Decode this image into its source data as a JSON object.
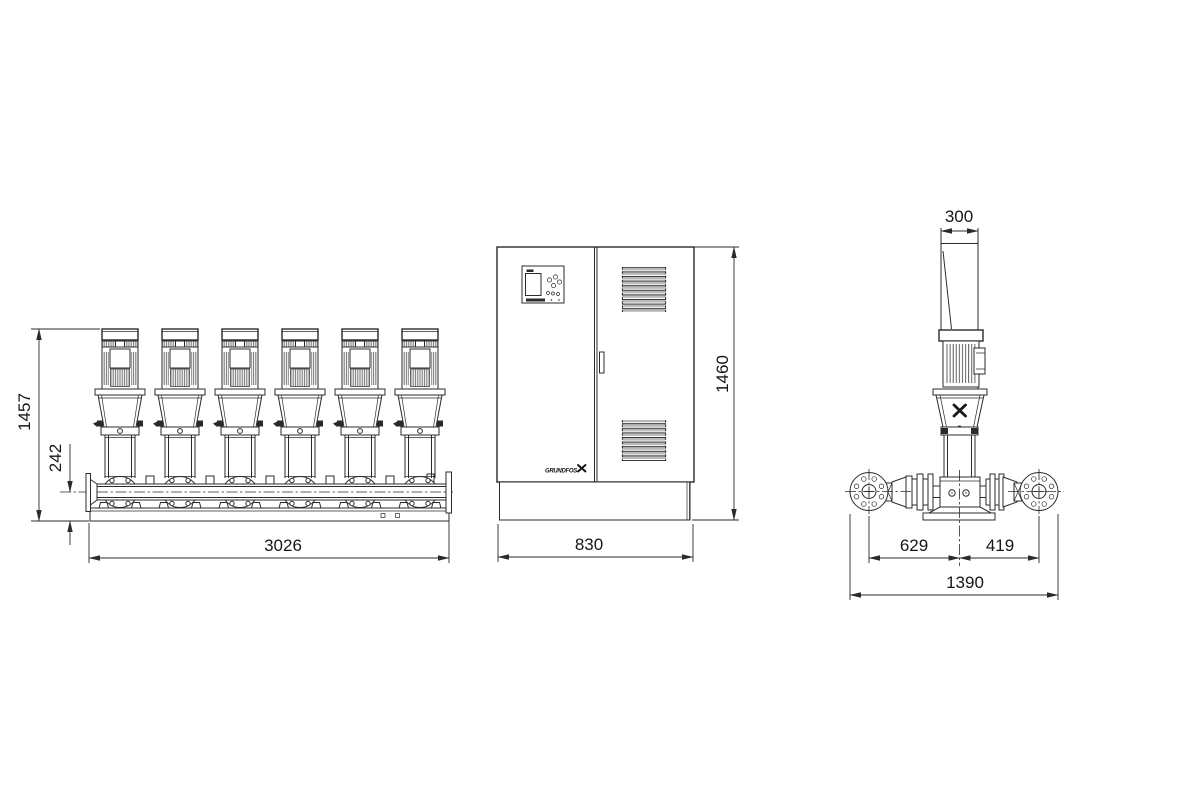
{
  "brand": {
    "logo_text": "GRUNDFOS"
  },
  "front_view": {
    "pump_count": 6,
    "height": "1457",
    "base_height": "242",
    "width": "3026"
  },
  "cabinet_view": {
    "height": "1460",
    "width": "830"
  },
  "side_view": {
    "depth": "300",
    "left_flange_offset": "629",
    "right_flange_offset": "419",
    "overall_width": "1390"
  }
}
